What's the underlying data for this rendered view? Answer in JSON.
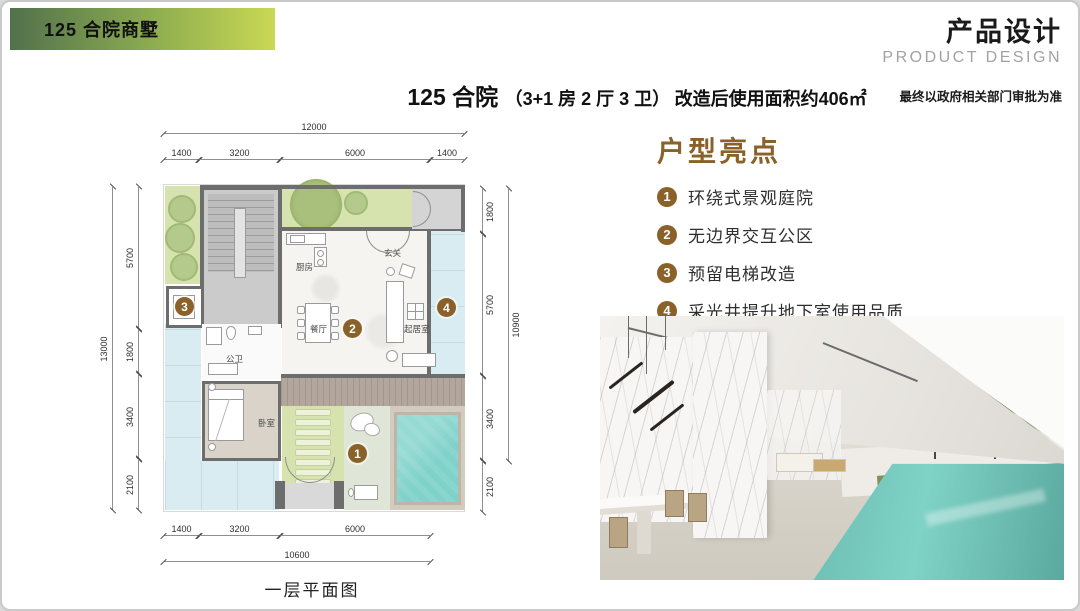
{
  "banner": {
    "label": "125 合院商墅",
    "gradient_start": "#51714d",
    "gradient_end": "#c9d854"
  },
  "header": {
    "title_cn": "产品设计",
    "title_en": "PRODUCT DESIGN",
    "disclaimer": "最终以政府相关部门审批为准"
  },
  "main_title": {
    "name": "125 合院",
    "spec": "（3+1 房 2 厅 3 卫）",
    "area": "改造后使用面积约406㎡"
  },
  "highlights": {
    "title": "户型亮点",
    "accent_color": "#8a6128",
    "items": [
      {
        "num": "1",
        "label": "环绕式景观庭院"
      },
      {
        "num": "2",
        "label": "无边界交互公区"
      },
      {
        "num": "3",
        "label": "预留电梯改造"
      },
      {
        "num": "4",
        "label": "采光井提升地下室使用品质"
      }
    ]
  },
  "floor_plan": {
    "caption": "一层平面图",
    "rooms": {
      "kitchen": "厨房",
      "foyer": "玄关",
      "dining": "餐厅",
      "living": "起居室",
      "bath": "公卫",
      "bedroom": "卧室"
    },
    "markers": {
      "m1": "1",
      "m2": "2",
      "m3": "3",
      "m4": "4"
    },
    "dims": {
      "top": {
        "overall": "12000",
        "segments": [
          "1400",
          "3200",
          "6000",
          "1400"
        ]
      },
      "bottom": {
        "overall": "10600",
        "segments": [
          "1400",
          "3200",
          "6000"
        ]
      },
      "left": {
        "overall": "13000",
        "segments": [
          "5700",
          "1800",
          "3400",
          "2100"
        ]
      },
      "right": {
        "overall": "10900",
        "segments": [
          "1800",
          "5700",
          "3400",
          "2100"
        ]
      }
    },
    "colors": {
      "garden": "#d6e3ae",
      "tree": "#a9c07c",
      "pool": "#7fd2ca",
      "light_well": "#d9ecf2",
      "wall": "#6d6d6d",
      "deck": "#b3a69d",
      "stair": "#cbcbcb",
      "marker": "#8a6128"
    }
  }
}
